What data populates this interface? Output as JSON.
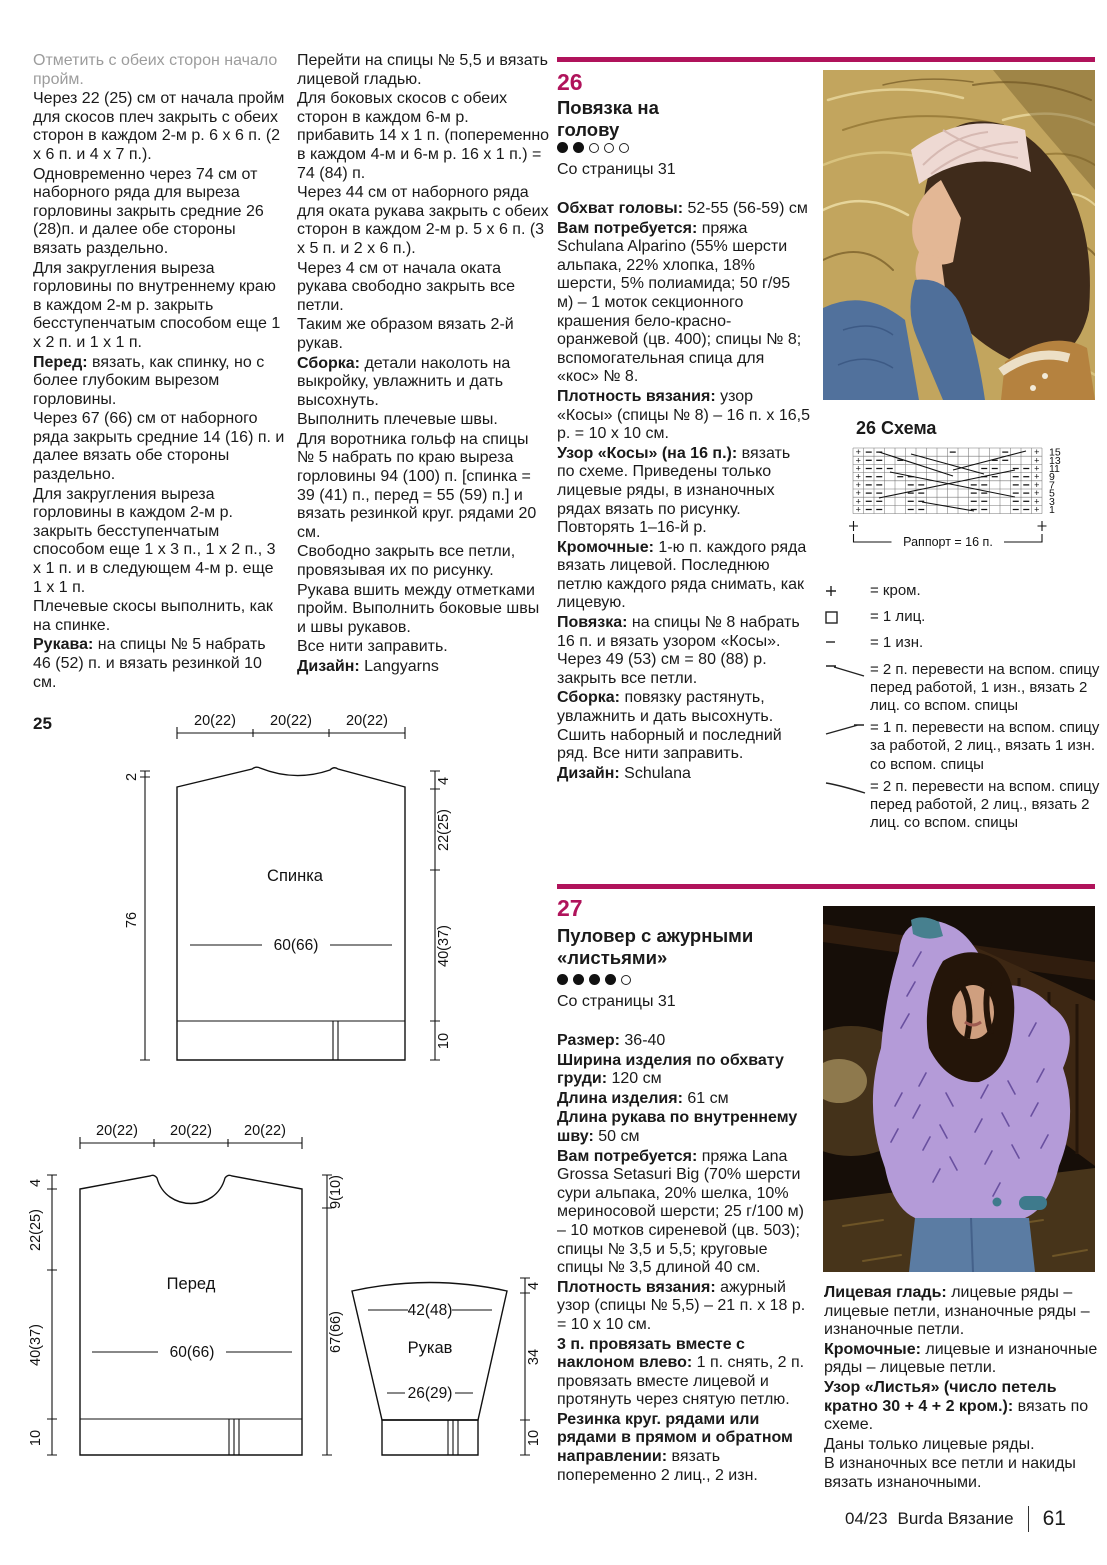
{
  "accent_color": "#b0135b",
  "col1": {
    "paras": [
      {
        "b": "",
        "t": "Отметить с обеих сторон начало пройм."
      },
      {
        "b": "",
        "t": "Через 22 (25) см от начала пройм для скосов плеч закрыть с обеих сторон в каждом 2-м р. 6 x 6 п. (2 x 6 п. и 4 x 7 п.)."
      },
      {
        "b": "",
        "t": "Одновременно через 74 см от наборного ряда для выреза горловины закрыть средние 26 (28)п. и далее обе стороны вязать раздельно."
      },
      {
        "b": "",
        "t": "Для закругления выреза горловины по внутреннему краю в каждом 2-м р. закрыть бесступенчатым способом еще 1 x 2 п. и 1 x 1 п."
      },
      {
        "b": "Перед:",
        "t": " вязать, как спинку, но с более глубоким вырезом горловины."
      },
      {
        "b": "",
        "t": "Через 67 (66) см от наборного ряда закрыть средние 14 (16) п. и далее вязать обе стороны раздельно."
      },
      {
        "b": "",
        "t": "Для закругления выреза горловины в каждом 2-м р. закрыть бесступенчатым способом еще 1 x 3 п., 1 x 2 п., 3 x 1 п. и в следующем 4-м р. еще 1 x 1 п."
      },
      {
        "b": "",
        "t": "Плечевые скосы выполнить, как на спинке."
      },
      {
        "b": "Рукава:",
        "t": " на спицы № 5 набрать 46 (52) п. и вязать резинкой 10 см."
      }
    ]
  },
  "col2": {
    "paras": [
      {
        "b": "",
        "t": "Перейти на спицы № 5,5 и вязать лицевой гладью."
      },
      {
        "b": "",
        "t": "Для боковых скосов с обеих сторон в каждом 6-м р. прибавить 14 x 1 п. (попеременно в каждом 4-м и 6-м р. 16 x 1 п.) = 74 (84) п."
      },
      {
        "b": "",
        "t": "Через 44 см от наборного ряда для оката рукава закрыть с обеих сторон в каждом 2-м р. 5 x 6 п. (3 x 5 п. и 2 x 6 п.)."
      },
      {
        "b": "",
        "t": "Через 4 см от начала оката рукава свободно закрыть все петли."
      },
      {
        "b": "",
        "t": "Таким же образом вязать 2-й рукав."
      },
      {
        "b": "Сборка:",
        "t": " детали наколоть на выкройку, увлажнить и дать высохнуть."
      },
      {
        "b": "",
        "t": "Выполнить плечевые швы."
      },
      {
        "b": "",
        "t": "Для воротника гольф на спицы № 5 набрать по краю выреза горловины 94 (100) п. [спинка = 39 (41) п., перед = 55 (59) п.] и вязать резинкой круг. рядами 20 см."
      },
      {
        "b": "",
        "t": "Свободно закрыть все петли, провязывая их по рисунку."
      },
      {
        "b": "",
        "t": "Рукава вшить между отметками пройм. Выполнить боковые швы и швы рукавов."
      },
      {
        "b": "",
        "t": "Все нити заправить."
      },
      {
        "b": "Дизайн:",
        "t": " Langyarns"
      }
    ]
  },
  "p26": {
    "number": "26",
    "title": "Повязка на голову",
    "difficulty": {
      "filled": 2,
      "total": 5
    },
    "from_page": "Со страницы 31",
    "paras": [
      {
        "b": "Обхват головы:",
        "t": " 52-55 (56-59) см"
      },
      {
        "b": "Вам потребуется:",
        "t": " пряжа Schulana Alparino (55% шерсти альпака, 22% хлопка, 18% шерсти, 5% полиамида; 50 г/95 м) – 1 моток секционного крашения бело-красно-оранжевой (цв. 400); спицы № 8; вспомогательная спица для «кос» № 8."
      },
      {
        "b": "Плотность вязания:",
        "t": " узор «Косы» (спицы № 8) – 16 п. x 16,5 р. = 10 x 10 см."
      },
      {
        "b": "Узор «Косы» (на 16 п.):",
        "t": " вязать по схеме. Приведены только лицевые ряды, в изнаночных рядах вязать по рисунку. Повторять 1–16-й р."
      },
      {
        "b": "Кромочные:",
        "t": " 1-ю п. каждого ряда вязать лицевой. Последнюю петлю каждого ряда снимать, как лицевую."
      },
      {
        "b": "Повязка:",
        "t": " на спицы № 8 набрать 16 п. и вязать узором «Косы». Через 49 (53) см = 80 (88) р. закрыть все петли."
      },
      {
        "b": "Сборка:",
        "t": " повязку растянуть, увлажнить и дать высохнуть. Сшить наборный и последний ряд. Все нити заправить."
      },
      {
        "b": "Дизайн:",
        "t": " Schulana"
      }
    ]
  },
  "p27": {
    "number": "27",
    "title": "Пуловер с ажурными «листьями»",
    "difficulty": {
      "filled": 4,
      "total": 5
    },
    "from_page": "Со страницы 31",
    "paras": [
      {
        "b": "Размер:",
        "t": " 36-40"
      },
      {
        "b": "Ширина изделия по обхвату груди:",
        "t": " 120 см"
      },
      {
        "b": "Длина изделия:",
        "t": " 61 см"
      },
      {
        "b": "Длина рукава по внутреннему шву:",
        "t": " 50 см"
      },
      {
        "b": "Вам потребуется:",
        "t": " пряжа Lana Grossa Setasuri Big (70% шерсти сури альпака, 20% шелка, 10% мериносовой шерсти; 25 г/100 м) – 10 мотков сиреневой (цв. 503); спицы № 3,5 и 5,5; круговые спицы № 3,5 длиной 40 см."
      },
      {
        "b": "Плотность вязания:",
        "t": " ажурный узор (спицы № 5,5) – 21 п. x 18 р. = 10 x 10 см."
      },
      {
        "b": "3 п. провязать вместе с наклоном влево:",
        "t": " 1 п. снять, 2 п. провязать вместе лицевой и протянуть через снятую петлю."
      },
      {
        "b": "Резинка круг. рядами или рядами в прямом и обратном направлении:",
        "t": " вязать попеременно 2 лиц., 2 изн."
      }
    ]
  },
  "p27right": {
    "paras": [
      {
        "b": "Лицевая гладь:",
        "t": " лицевые ряды – лицевые петли, изнаночные ряды – изнаночные петли."
      },
      {
        "b": "Кромочные:",
        "t": " лицевые и изнаночные ряды – лицевые петли."
      },
      {
        "b": "Узор «Листья» (число петель кратно 30 + 4 + 2 кром.):",
        "t": " вязать по схеме."
      },
      {
        "b": "",
        "t": "Даны только лицевые ряды."
      },
      {
        "b": "",
        "t": "В изнаночных все петли и накиды вязать изнаночными."
      }
    ]
  },
  "chart": {
    "title": "26 Схема",
    "rows": [
      "+--......-....-..+",
      "+--.-........--..+",
      "+---........--.--+",
      "+--.--......--.--+",
      "+--..--....--..--+",
      "+--..--....--..--+",
      "+--..--....--..--+",
      "+--..--....--..--+"
    ],
    "row_numbers": [
      "15",
      "13",
      "11",
      "9",
      "7",
      "5",
      "3",
      "1"
    ],
    "rapport": "Раппорт = 16 п."
  },
  "legend": {
    "items": [
      {
        "sym": "plus",
        "text": "= кром."
      },
      {
        "sym": "square",
        "text": "= 1 лиц."
      },
      {
        "sym": "dash",
        "text": "= 1 изн."
      },
      {
        "sym": "cable-front-2-1",
        "text": "= 2 п. перевести на вспом. спицу перед работой, 1 изн., вязать 2 лиц. со вспом. спицы"
      },
      {
        "sym": "cable-back-1-2",
        "text": "= 1 п. перевести на вспом. спицу за работой, 2 лиц., вязать 1 изн. со вспом. спицы"
      },
      {
        "sym": "cable-front-2-2",
        "text": "= 2 п. перевести на вспом. спицу перед работой, 2 лиц., вязать 2 лиц. со вспом. спицы"
      }
    ]
  },
  "diagrams": {
    "label": "25",
    "back": {
      "name": "Спинка",
      "top_widths": [
        "20(22)",
        "20(22)",
        "20(22)"
      ],
      "width_mid": "60(66)",
      "left": [
        "2",
        "76"
      ],
      "right": [
        "4",
        "22(25)",
        "40(37)",
        "10"
      ]
    },
    "front": {
      "name": "Перед",
      "top_widths": [
        "20(22)",
        "20(22)",
        "20(22)"
      ],
      "width_mid": "60(66)",
      "left": [
        "4",
        "22(25)",
        "40(37)",
        "10"
      ],
      "right": [
        "9(10)",
        "67(66)"
      ]
    },
    "sleeve": {
      "name": "Рукав",
      "width_top": "42(48)",
      "width_low": "26(29)",
      "right": [
        "4",
        "34",
        "10"
      ]
    }
  },
  "footer": {
    "issue": "04/23",
    "magazine": "Burda Вязание",
    "page": "61"
  }
}
